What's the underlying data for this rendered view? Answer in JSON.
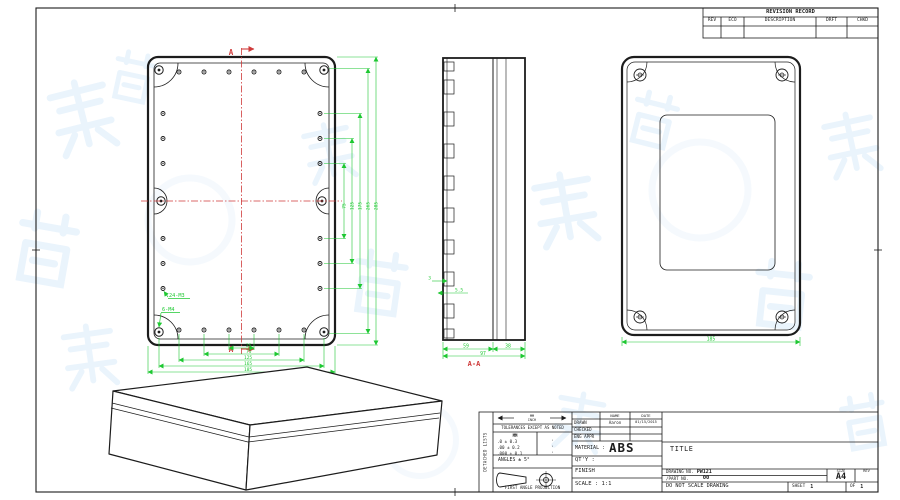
{
  "colors": {
    "line": "#1c1c1c",
    "dimension_green": "#1ec832",
    "centerline_red": "#cf3a3a",
    "watermark_blue": "#d9ebfa"
  },
  "revision_table": {
    "title": "REVISION RECORD",
    "columns": [
      "REV",
      "ECO",
      "DESCRIPTION",
      "DRFT",
      "CHKD"
    ]
  },
  "front_view": {
    "section_label_top": "A",
    "section_label_bottom": "A",
    "note_holes_small": "24-M3",
    "note_holes_large": "6-M4",
    "dims_bottom": [
      "25",
      "75",
      "125",
      "165",
      "185"
    ],
    "dims_right": [
      "75",
      "125",
      "175",
      "265",
      "285"
    ]
  },
  "section_view": {
    "label": "A-A",
    "dim_body": "59",
    "dim_lid": "38",
    "dim_total": "97",
    "dim_rib": "3",
    "dim_slot": "5.5"
  },
  "back_view": {
    "dim_width": "185"
  },
  "title_block": {
    "side_label": "DETACHED LISTS",
    "units_top": "MM",
    "units_bottom": "INCH",
    "tolerance_note": "TOLERANCES EXCEPT AS NOTED",
    "tol_unit_header": "MM",
    "tol_rows": [
      ".0 ± 0.3",
      ".00 ± 0.2",
      ".000 ± 0.1"
    ],
    "tol_marks": [
      "·",
      "·",
      "·"
    ],
    "angles_note": "ANGLES ± 5°",
    "projection_note": "FIRST ANGLE PROJECTION",
    "name_header": "NAME",
    "date_header": "DATE",
    "drawn_label": "DRAWN",
    "drawn_name": "Aaron",
    "drawn_date": "01/15/2015",
    "checked_label": "CHECKED",
    "eng_appr_label": "ENG APPR",
    "material_label": "MATERIAL :",
    "material_value": "ABS",
    "qty_label": "QT'Y :",
    "finish_label": "FINISH",
    "scale_label": "SCALE : 1:1",
    "title_label": "TITLE",
    "drawing_no_label": "DRAWING NO.",
    "drawing_no_value": "PW121",
    "part_no_label": "/PART NO.",
    "part_no_value": "00",
    "size_label": "SIZE",
    "size_value": "A4",
    "rev_label": "REV",
    "dns_note": "DO NOT SCALE DRAWING",
    "sheet_label": "SHEET",
    "sheet_value": "1",
    "of_label": "OF",
    "of_value": "1"
  }
}
